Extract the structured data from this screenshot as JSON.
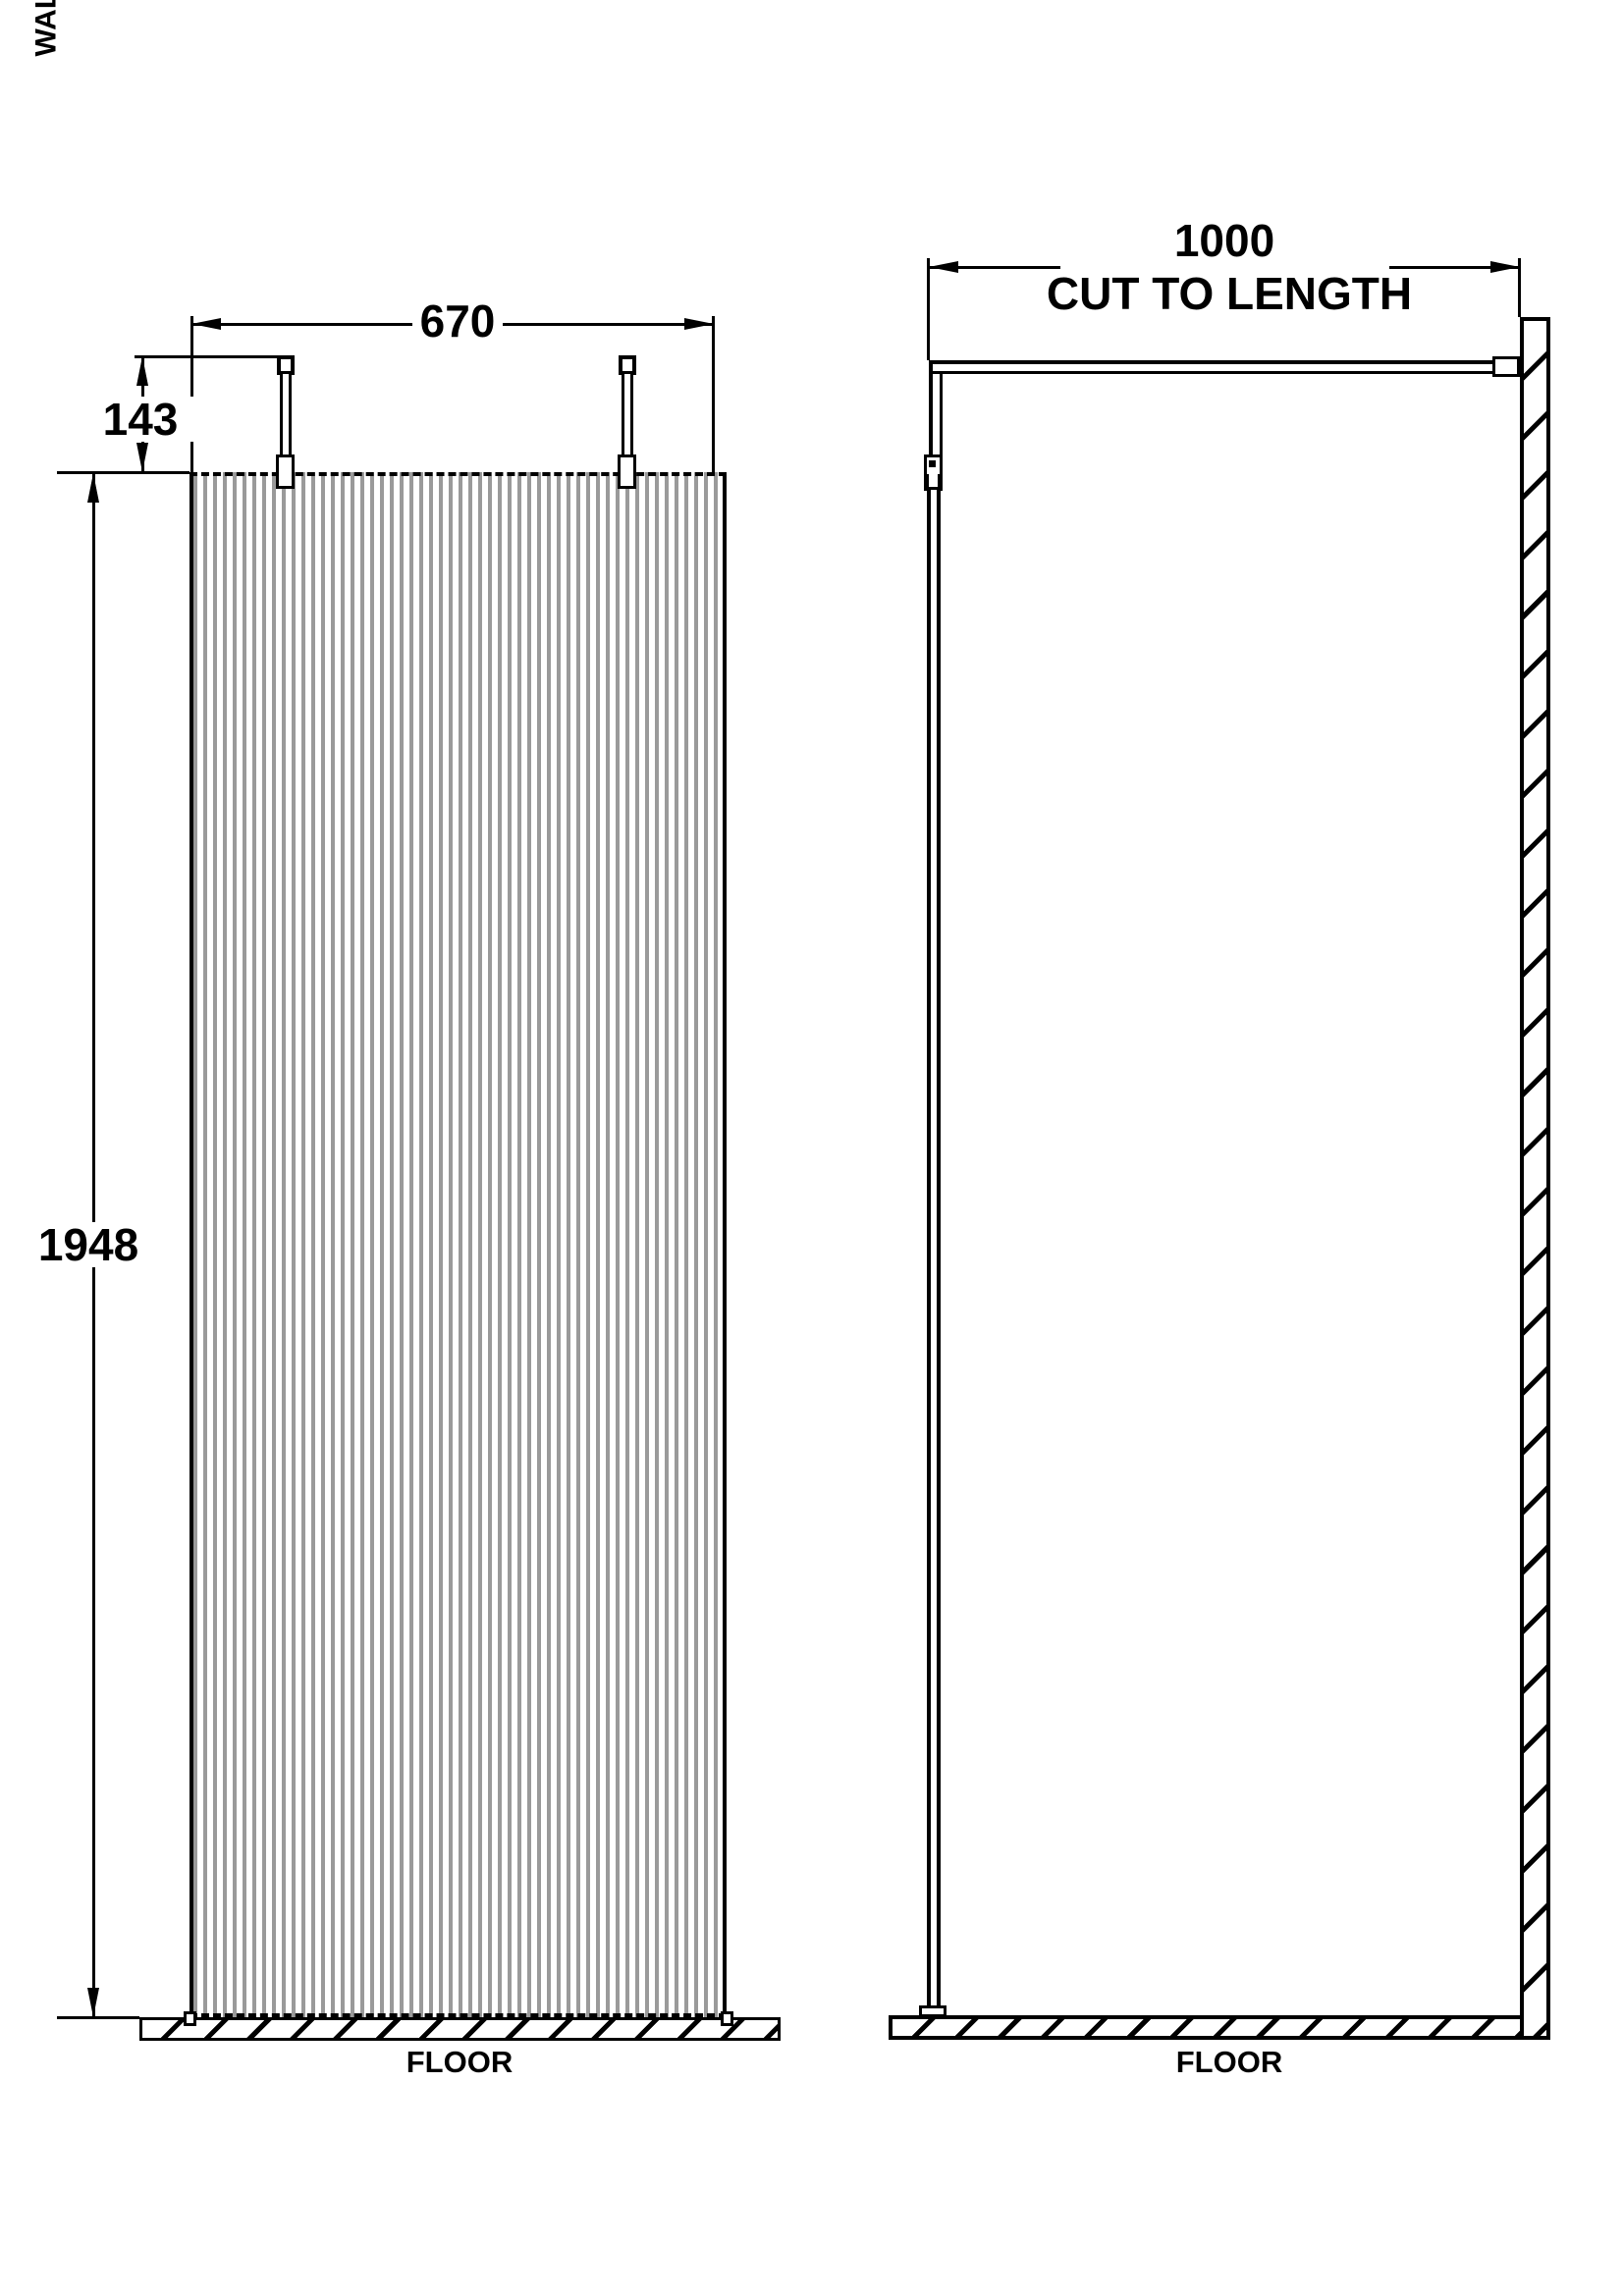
{
  "front_view": {
    "width_dim": "670",
    "bracket_height_dim": "143",
    "panel_height_dim": "1948",
    "floor_label": "FLOOR"
  },
  "side_view": {
    "support_bar_dim": "1000",
    "support_bar_note": "CUT TO LENGTH",
    "floor_label": "FLOOR",
    "wall_label": "WALL"
  },
  "colors": {
    "line": "#000000",
    "flute": "#9a9a9a",
    "background": "#ffffff"
  }
}
